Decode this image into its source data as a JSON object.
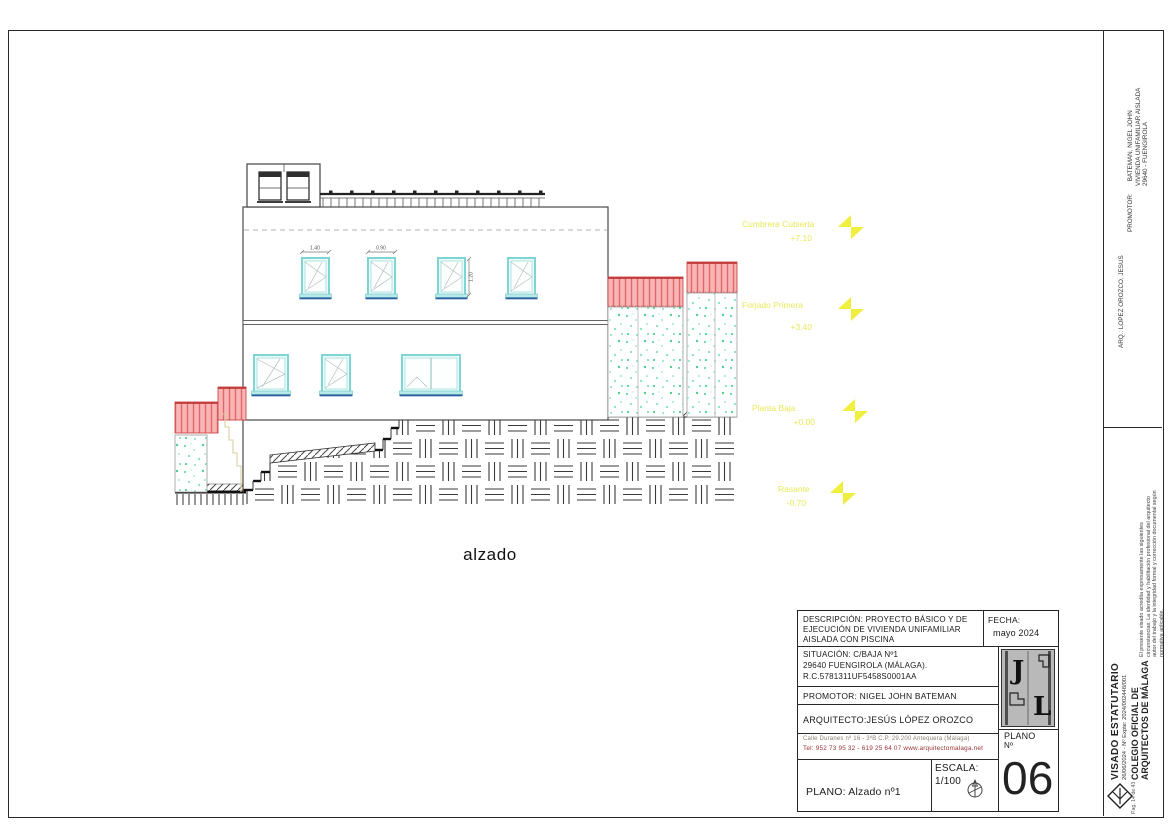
{
  "drawing": {
    "caption": "alzado",
    "watermark": "GeoEstructura",
    "dimensions": {
      "upper_window_1_width": "1.40",
      "upper_window_2_width": "0.90",
      "upper_window_3_height": "1.20"
    },
    "levels": [
      {
        "label": "Cumbrera Cubierta",
        "value": "+7.10"
      },
      {
        "label": "Forjado Primera",
        "value": "+3.40"
      },
      {
        "label": "Planta Baja",
        "value": "+0.00"
      },
      {
        "label": "Rasante",
        "value": "-0.70"
      }
    ]
  },
  "title_block": {
    "description_line1": "DESCRIPCIÓN: PROYECTO BÁSICO Y DE",
    "description_line2": "EJECUCIÓN DE VIVIENDA UNIFAMILIAR",
    "description_line3": "AISLADA CON PISCINA",
    "fecha_label": "FECHA:",
    "fecha_value": "mayo  2024",
    "situacion_line1": "SITUACIÓN:  C/BAJA Nº1",
    "situacion_line2": "29640 FUENGIROLA (MÁLAGA).",
    "situacion_line3": "R.C.5781311UF5458S0001AA",
    "promotor": "PROMOTOR: NIGEL JOHN BATEMAN",
    "arquitecto": "ARQUITECTO:JESÚS LÓPEZ OROZCO",
    "address": "Calle Duranes nº 16 - 3ºB      C.P. 29.200      Antequera (Málaga)",
    "phone": "Tel: 952 73 95 32 - 619 25 64 07 www.arquitectomalaga.net",
    "plano": "PLANO: Alzado nº1",
    "escala_label": "ESCALA:",
    "escala_value": "1/100",
    "plano_num_label": "PLANO",
    "plano_num_sub": "Nº",
    "plano_num": "06",
    "logo_j": "J",
    "logo_l": "L"
  },
  "sidebar": {
    "promotor_label": "PROMOTOR:",
    "promotor_line1": "BATEMAN, NIGEL JOHN",
    "promotor_line2": "VIVIENDA UNIFAMILIAR AISLADA",
    "promotor_line3": "29640 - FUENGIROLA",
    "arq": "ARQ.: LOPEZ OROZCO, JESUS",
    "legal": "El presente visado acredita expresamente las siguientes circunstancias: La identidad y habilitación profesional del arquitecto autor del trabajo y la integridad formal y corrección documental según normativa aplicable.",
    "visado_title": "VISADO ESTATUTARIO",
    "visado_ref": "26/06/2024 - Nº Expte: 2024/002448/001",
    "colegio_line1": "COLEGIO OFICIAL DE",
    "colegio_line2": "ARQUITECTOS DE MÁLAGA",
    "page": "Pag. 14 de 43"
  },
  "colors": {
    "window_cyan": "#7fd4d4",
    "sill_blue": "#2a5f9e",
    "fence_pink": "#f7b5b5",
    "fence_red": "#cc4a4a",
    "vegetation_green": "#62d9a2",
    "level_yellow": "#e9e95a",
    "phone_red": "#993333"
  }
}
